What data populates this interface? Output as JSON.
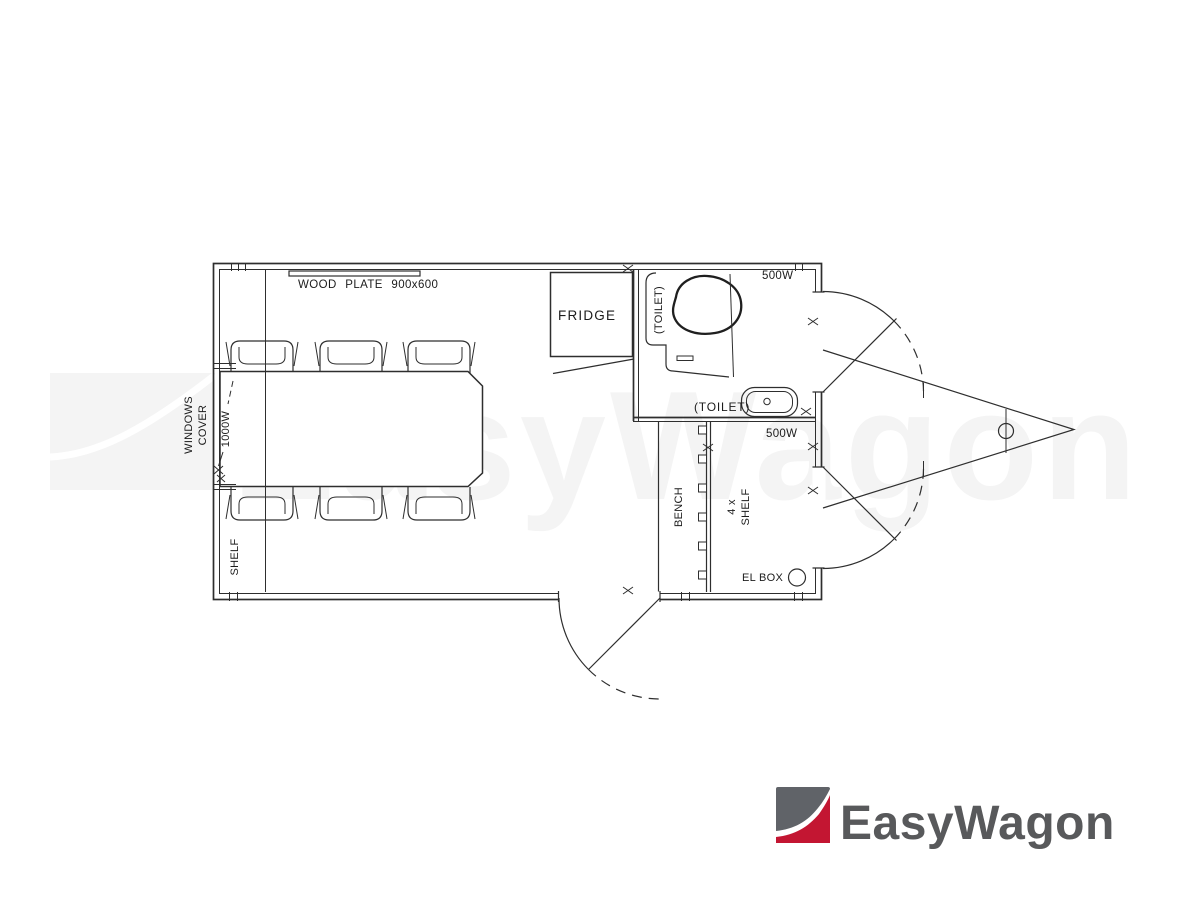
{
  "watermark": {
    "text": "EasyWagon",
    "color": "#f4f4f4"
  },
  "logo": {
    "text": "EasyWagon",
    "text_color": "#58595b",
    "icon_gray": "#606368",
    "icon_red": "#c31632"
  },
  "plan": {
    "line_color": "#2e2e2e",
    "labels": {
      "wood_plate": "WOOD PLATE 900x600",
      "fridge": "FRIDGE",
      "toilet_room": "(TOILET)",
      "toilet_sink": "(TOILET)",
      "heater_top": "500W",
      "heater_bottom": "500W",
      "heater_left": "1000W",
      "windows_cover_line1": "WINDOWS",
      "windows_cover_line2": "COVER",
      "shelf_left": "SHELF",
      "bench": "BENCH",
      "shelf_4x_line1": "4 x",
      "shelf_4x_line2": "SHELF",
      "el_box": "EL BOX"
    }
  }
}
